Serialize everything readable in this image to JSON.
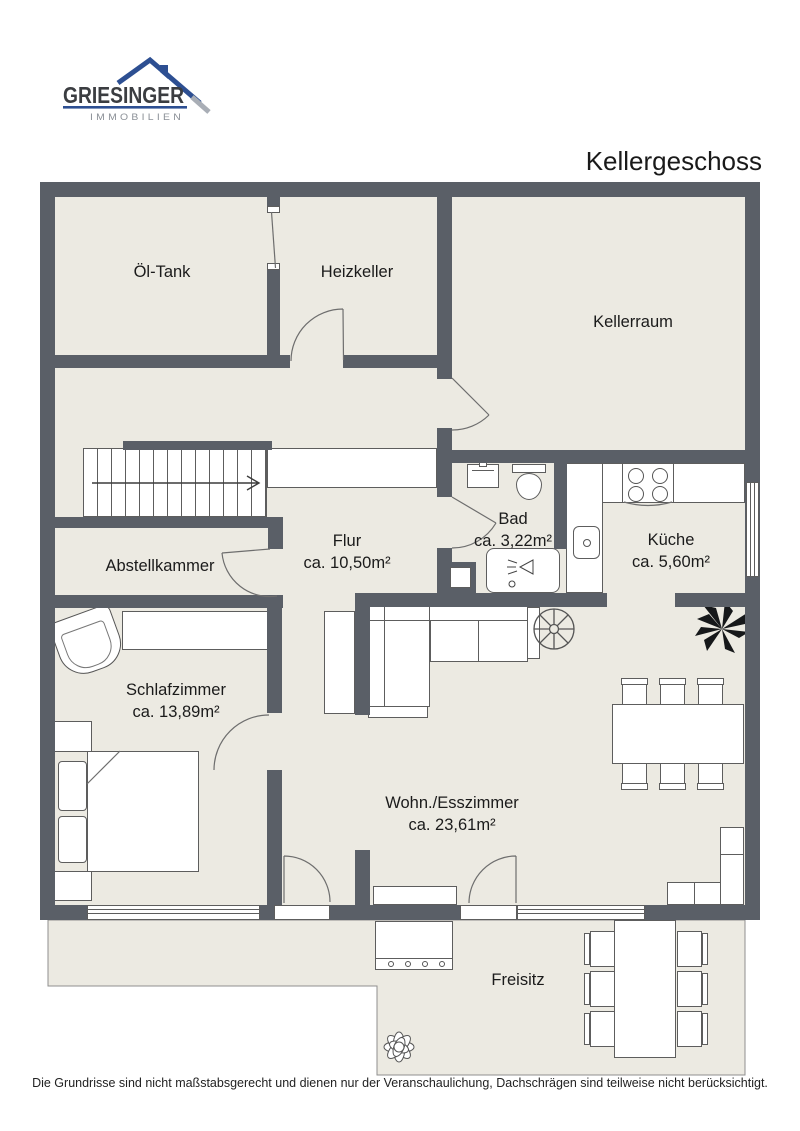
{
  "header": {
    "logo_brand": "GRIESINGER",
    "logo_subtitle": "IMMOBILIEN",
    "title": "Kellergeschoss"
  },
  "rooms": [
    {
      "label": "Öl-Tank"
    },
    {
      "label": "Heizkeller"
    },
    {
      "label": "Kellerraum"
    },
    {
      "label": "Flur",
      "area": "ca. 10,50m²"
    },
    {
      "label": "Bad",
      "area": "ca. 3,22m²"
    },
    {
      "label": "Küche",
      "area": "ca. 5,60m²"
    },
    {
      "label": "Abstellkammer"
    },
    {
      "label": "Schlafzimmer",
      "area": "ca. 13,89m²"
    },
    {
      "label": "Wohn./Esszimmer",
      "area": "ca. 23,61m²"
    },
    {
      "label": "Freisitz"
    }
  ],
  "footer": {
    "disclaimer": "Die Grundrisse sind nicht maßstabsgerecht und dienen nur der Veranschaulichung, Dachschrägen sind teilweise nicht berücksichtigt."
  },
  "colors": {
    "wall": "#5a5f67",
    "floor": "#ECEAE2",
    "logo_blue": "#2d4f92",
    "logo_gray": "#8b9097",
    "text": "#1a1a1a"
  }
}
